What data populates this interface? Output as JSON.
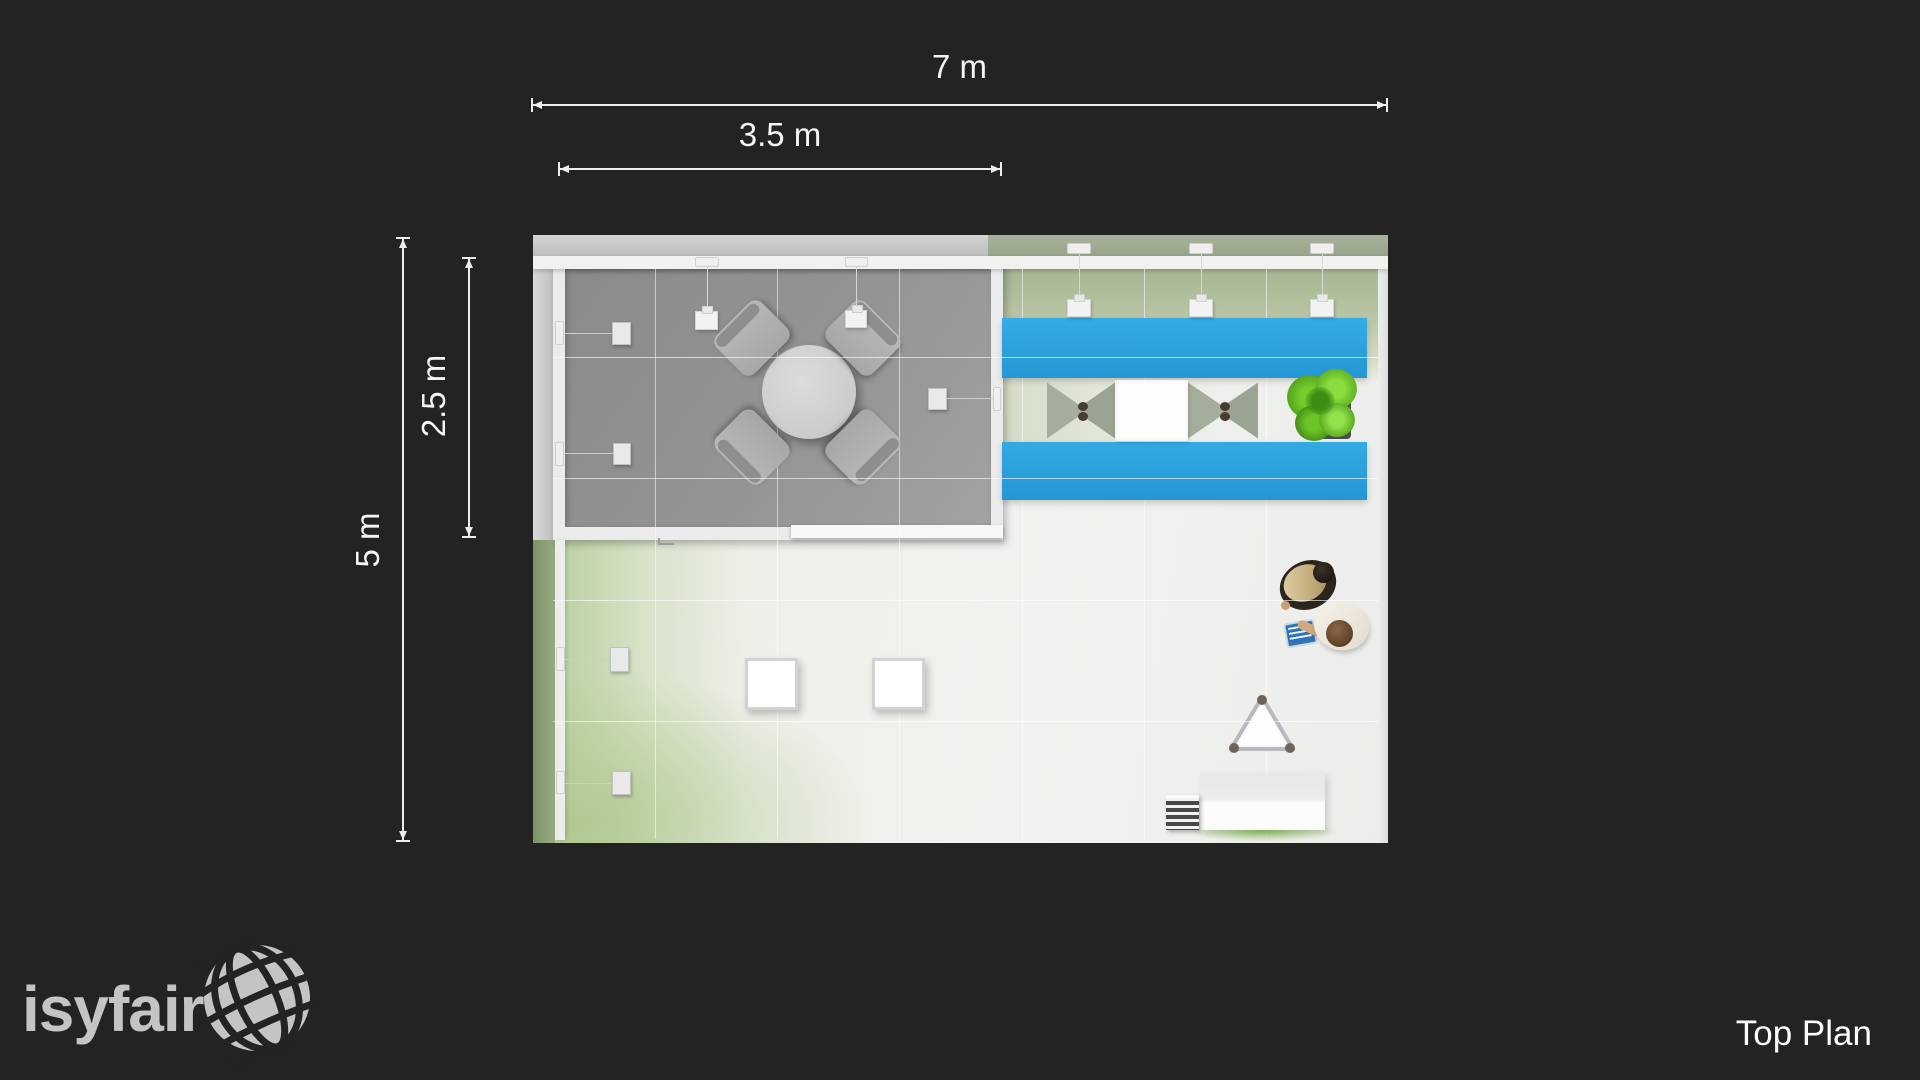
{
  "page": {
    "background": "#232323",
    "accent_blue": "#2ba6e0"
  },
  "brand": {
    "name": "isyfair",
    "logo_icon": "tiled-globe-icon",
    "color": "#c4c4c4"
  },
  "caption": {
    "text": "Top Plan"
  },
  "dimensions": {
    "width_total": {
      "label": "7 m"
    },
    "width_half": {
      "label": "3.5 m"
    },
    "depth_total": {
      "label": "5 m"
    },
    "depth_half": {
      "label": "2.5 m"
    }
  },
  "plan": {
    "view": "top",
    "booth_size_m": {
      "width": 7,
      "depth": 5
    },
    "meeting_room_size_m": {
      "width": 3.5,
      "depth": 2.5
    },
    "objects": [
      "meeting-room",
      "round-table",
      "meeting-chair x4",
      "wall-screen x5",
      "pendant-light x5",
      "blue-counter x2",
      "bar-stool x2",
      "bar-table",
      "plant",
      "seating-cube x2",
      "triangle-stool",
      "reception-desk",
      "brochure-rack",
      "visitor x2"
    ]
  }
}
